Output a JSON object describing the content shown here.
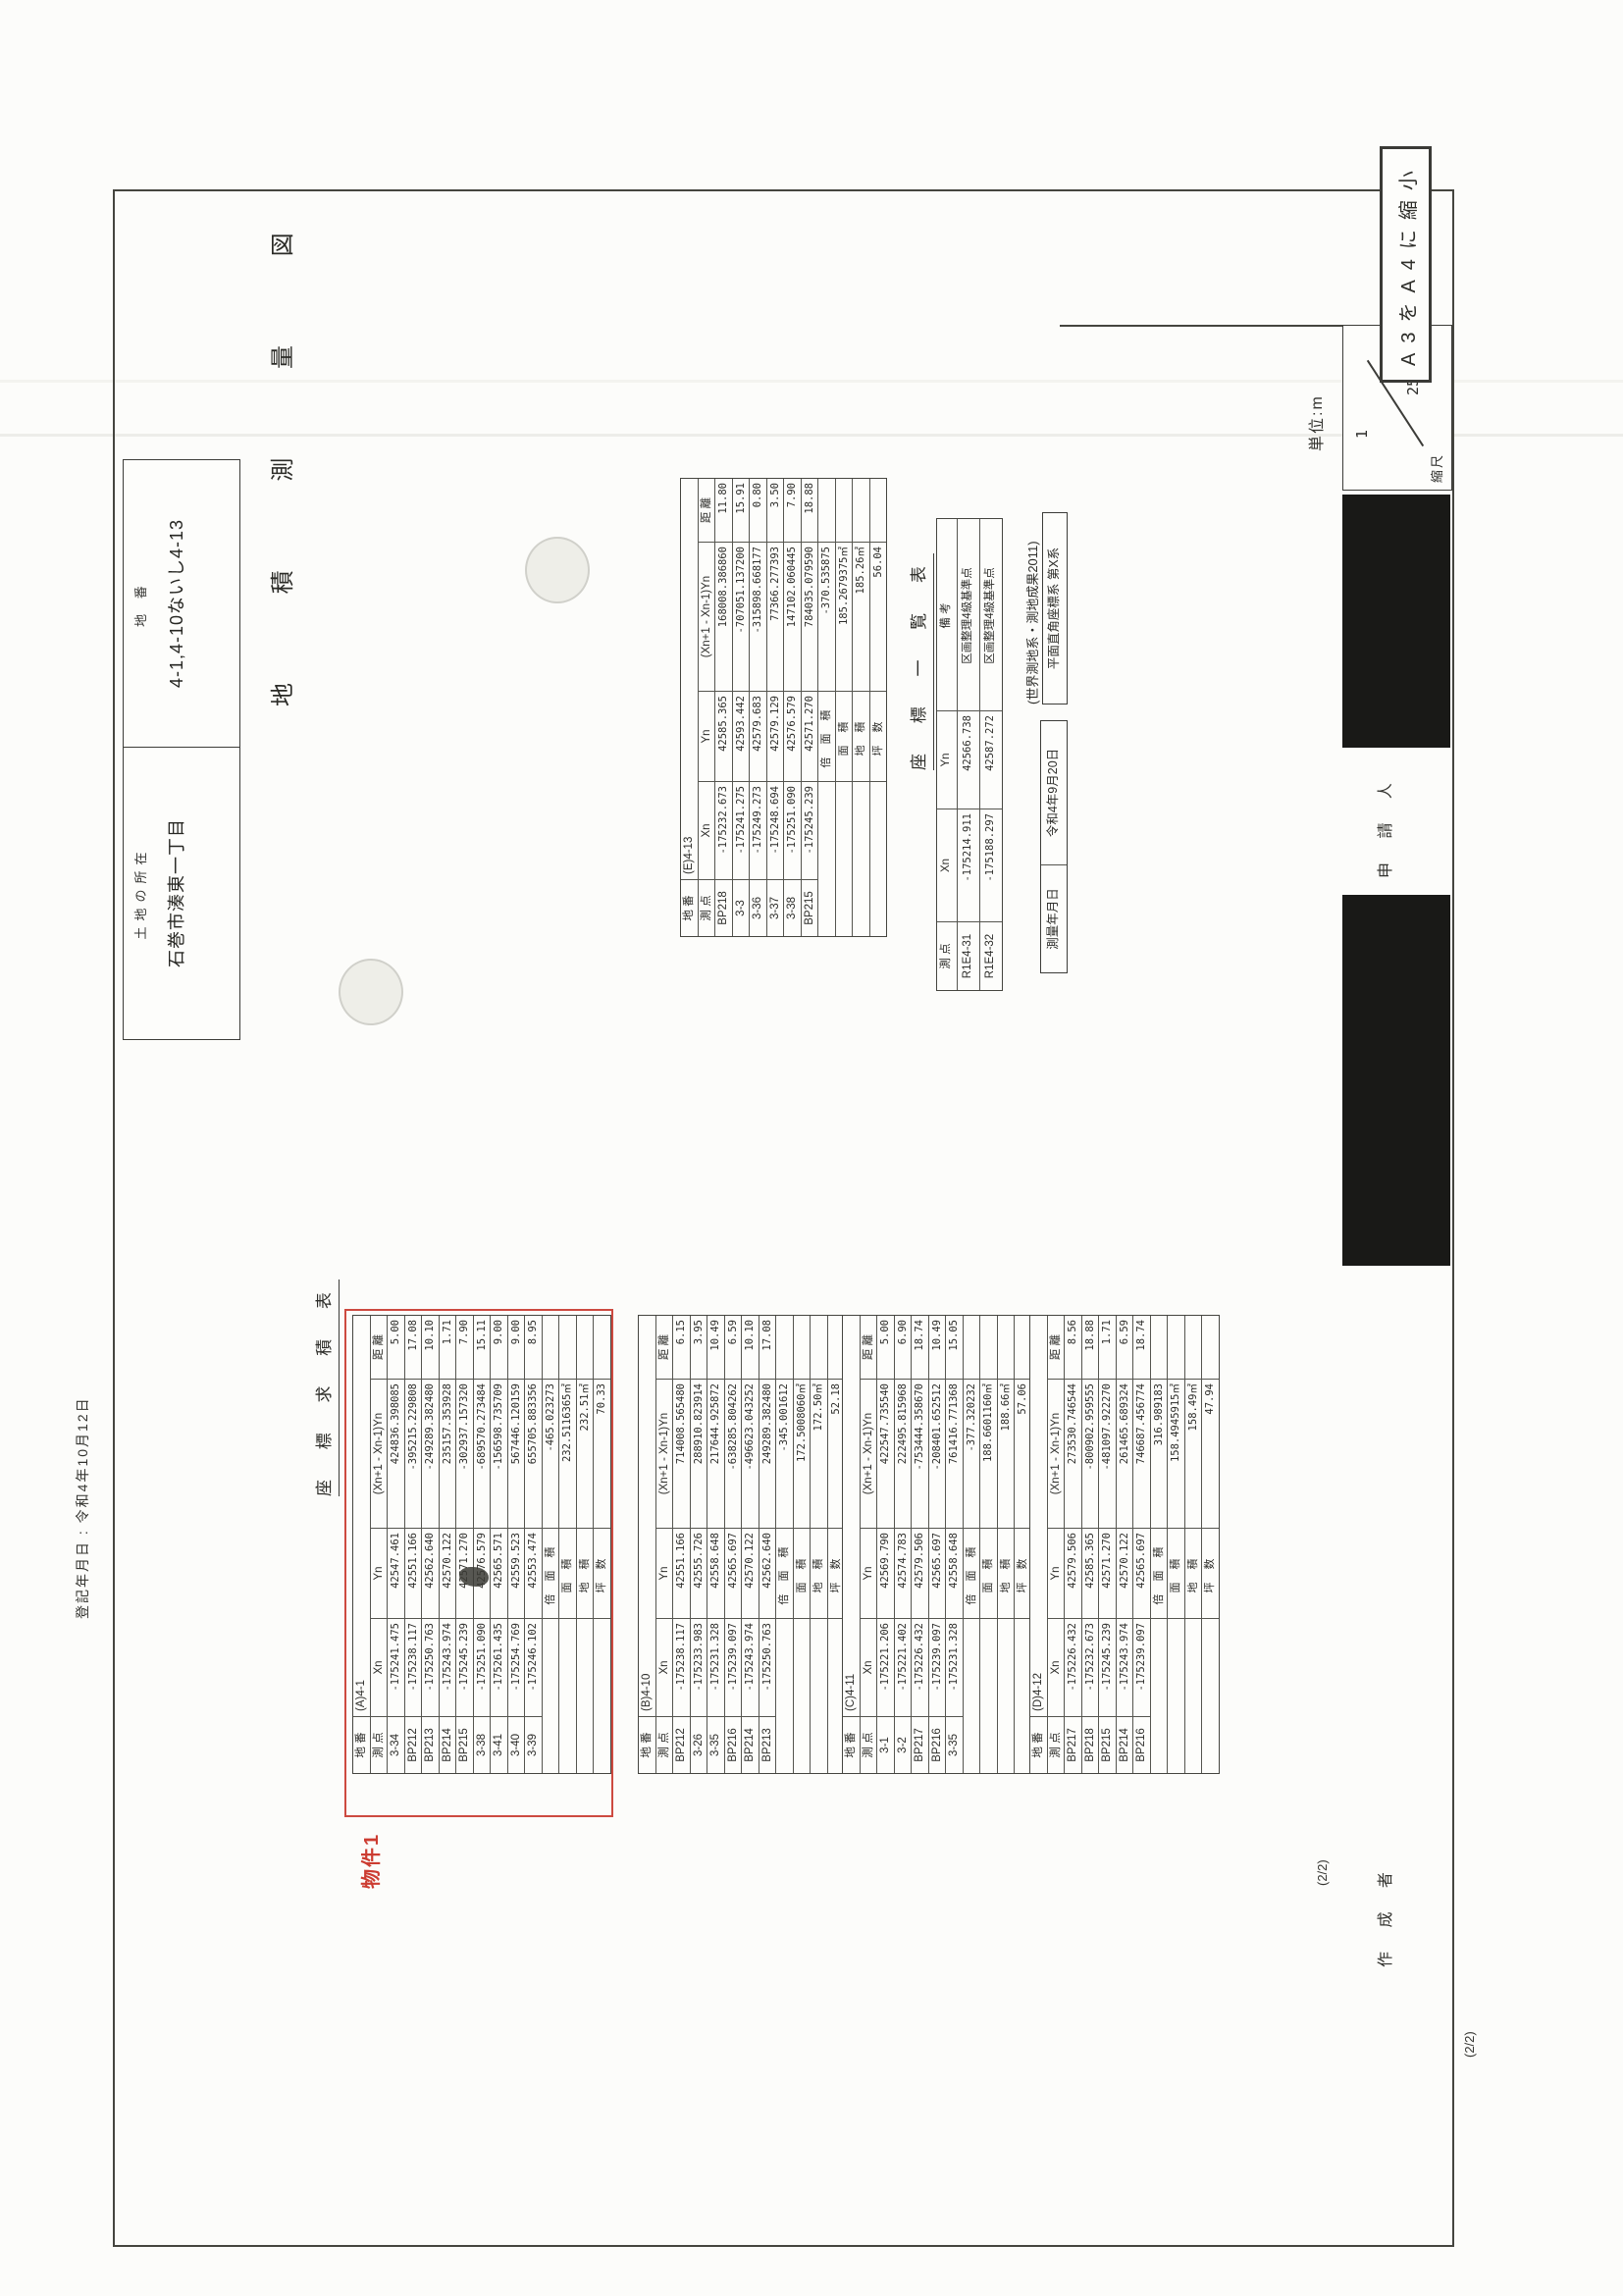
{
  "colors": {
    "accent_red": "#cd4a40",
    "redact_black": "#191917",
    "line_gray": "#45453f"
  },
  "document": {
    "copy_note": "A3をA4に縮小",
    "registration_date_note": "登記年月日 : 令和4年10月12日",
    "page_number_inner": "(2/2)",
    "page_number_outer": "(2/2)",
    "title": "地 積 測 量 図",
    "lot_number_label": "地 番",
    "lot_number_value": "4-1,4-10ないし4-13",
    "location_label": "土地の所在",
    "location_value": "石巻市湊東一丁目",
    "unit_note": "単位:m",
    "scale_label": "縮尺",
    "scale_numerator": "1",
    "scale_denominator": "250",
    "applicant_label": "申 請 人",
    "preparer_label": "作 成 者",
    "property_stamp": "物件1",
    "survey_table_title": "座 標 求 積 表",
    "coord_list_title": "座 標 一 覧 表",
    "survey_date_label": "測量年月日",
    "survey_date_value": "令和4年9月20日",
    "datum_note": "(世界測地系・測地成果2011)",
    "crs_note": "平面直角座標系 第X系"
  },
  "area_tables": [
    {
      "id": "A",
      "parcel_label": "地 番",
      "parcel": "(A)4-1",
      "headers": [
        "測 点",
        "Xn",
        "Yn",
        "(Xn+1 - Xn-1)Yn",
        "距 離"
      ],
      "rows": [
        [
          "3-34",
          "-175241.475",
          "42547.461",
          "424836.398085",
          "5.00"
        ],
        [
          "BP212",
          "-175238.117",
          "42551.166",
          "-395215.229808",
          "17.08"
        ],
        [
          "BP213",
          "-175250.763",
          "42562.640",
          "-249289.382480",
          "10.10"
        ],
        [
          "BP214",
          "-175243.974",
          "42570.122",
          "235157.353928",
          "1.71"
        ],
        [
          "BP215",
          "-175245.239",
          "42571.270",
          "-302937.157320",
          "7.90"
        ],
        [
          "3-38",
          "-175251.090",
          "42576.579",
          "-689570.273484",
          "15.11"
        ],
        [
          "3-41",
          "-175261.435",
          "42565.571",
          "-156598.735709",
          "9.00"
        ],
        [
          "3-40",
          "-175254.769",
          "42559.523",
          "567446.120159",
          "9.00"
        ],
        [
          "3-39",
          "-175246.102",
          "42553.474",
          "655705.883356",
          "8.95"
        ]
      ],
      "totals": [
        [
          "倍 面 積",
          "-465.023273"
        ],
        [
          "面  積",
          "232.5116365㎡"
        ],
        [
          "地  積",
          "232.51㎡"
        ],
        [
          "坪  数",
          "70.33"
        ]
      ]
    },
    {
      "id": "B",
      "parcel_label": "地 番",
      "parcel": "(B)4-10",
      "headers": [
        "測 点",
        "Xn",
        "Yn",
        "(Xn+1 - Xn-1)Yn",
        "距 離"
      ],
      "rows": [
        [
          "BP212",
          "-175238.117",
          "42551.166",
          "714008.565480",
          "6.15"
        ],
        [
          "3-26",
          "-175233.983",
          "42555.726",
          "288910.823914",
          "3.95"
        ],
        [
          "3-35",
          "-175231.328",
          "42558.648",
          "217644.925872",
          "10.49"
        ],
        [
          "BP216",
          "-175239.097",
          "42565.697",
          "-638285.804262",
          "6.59"
        ],
        [
          "BP214",
          "-175243.974",
          "42570.122",
          "-496623.043252",
          "10.10"
        ],
        [
          "BP213",
          "-175250.763",
          "42562.640",
          "249289.382480",
          "17.08"
        ]
      ],
      "totals": [
        [
          "倍 面 積",
          "-345.001612"
        ],
        [
          "面  積",
          "172.5008060㎡"
        ],
        [
          "地  積",
          "172.50㎡"
        ],
        [
          "坪  数",
          "52.18"
        ]
      ]
    },
    {
      "id": "C",
      "parcel_label": "地 番",
      "parcel": "(C)4-11",
      "headers": [
        "測 点",
        "Xn",
        "Yn",
        "(Xn+1 - Xn-1)Yn",
        "距 離"
      ],
      "rows": [
        [
          "3-1",
          "-175221.206",
          "42569.790",
          "422547.735540",
          "5.00"
        ],
        [
          "3-2",
          "-175221.402",
          "42574.783",
          "222495.815968",
          "6.90"
        ],
        [
          "BP217",
          "-175226.432",
          "42579.506",
          "-753444.358670",
          "18.74"
        ],
        [
          "BP216",
          "-175239.097",
          "42565.697",
          "-208401.652512",
          "10.49"
        ],
        [
          "3-35",
          "-175231.328",
          "42558.648",
          "761416.771368",
          "15.05"
        ]
      ],
      "totals": [
        [
          "倍 面 積",
          "-377.320232"
        ],
        [
          "面  積",
          "188.6601160㎡"
        ],
        [
          "地  積",
          "188.66㎡"
        ],
        [
          "坪  数",
          "57.06"
        ]
      ]
    },
    {
      "id": "D",
      "parcel_label": "地 番",
      "parcel": "(D)4-12",
      "headers": [
        "測 点",
        "Xn",
        "Yn",
        "(Xn+1 - Xn-1)Yn",
        "距 離"
      ],
      "rows": [
        [
          "BP217",
          "-175226.432",
          "42579.506",
          "273530.746544",
          "8.56"
        ],
        [
          "BP218",
          "-175232.673",
          "42585.365",
          "-800902.959555",
          "18.88"
        ],
        [
          "BP215",
          "-175245.239",
          "42571.270",
          "-481097.922270",
          "1.71"
        ],
        [
          "BP214",
          "-175243.974",
          "42570.122",
          "261465.689324",
          "6.59"
        ],
        [
          "BP216",
          "-175239.097",
          "42565.697",
          "746687.456774",
          "18.74"
        ]
      ],
      "totals": [
        [
          "倍 面 積",
          "316.989183"
        ],
        [
          "面  積",
          "158.4945915㎡"
        ],
        [
          "地  積",
          "158.49㎡"
        ],
        [
          "坪  数",
          "47.94"
        ]
      ]
    },
    {
      "id": "E",
      "parcel_label": "地 番",
      "parcel": "(E)4-13",
      "headers": [
        "測 点",
        "Xn",
        "Yn",
        "(Xn+1 - Xn-1)Yn",
        "距 離"
      ],
      "rows": [
        [
          "BP218",
          "-175232.673",
          "42585.365",
          "168008.386860",
          "11.80"
        ],
        [
          "3-3",
          "-175241.275",
          "42593.442",
          "-707051.137200",
          "15.91"
        ],
        [
          "3-36",
          "-175249.273",
          "42579.683",
          "-315898.668177",
          "0.80"
        ],
        [
          "3-37",
          "-175248.694",
          "42579.129",
          "77366.277393",
          "3.50"
        ],
        [
          "3-38",
          "-175251.090",
          "42576.579",
          "147102.060445",
          "7.90"
        ],
        [
          "BP215",
          "-175245.239",
          "42571.270",
          "784035.079590",
          "18.88"
        ]
      ],
      "totals": [
        [
          "倍 面 積",
          "-370.535875"
        ],
        [
          "面  積",
          "185.2679375㎡"
        ],
        [
          "地  積",
          "185.26㎡"
        ],
        [
          "坪  数",
          "56.04"
        ]
      ]
    }
  ],
  "coord_list": {
    "headers": [
      "測 点",
      "Xn",
      "Yn",
      "備  考"
    ],
    "rows": [
      [
        "R1E4-31",
        "-175214.911",
        "42566.738",
        "区画整理4級基準点"
      ],
      [
        "R1E4-32",
        "-175188.297",
        "42587.272",
        "区画整理4級基準点"
      ]
    ]
  }
}
